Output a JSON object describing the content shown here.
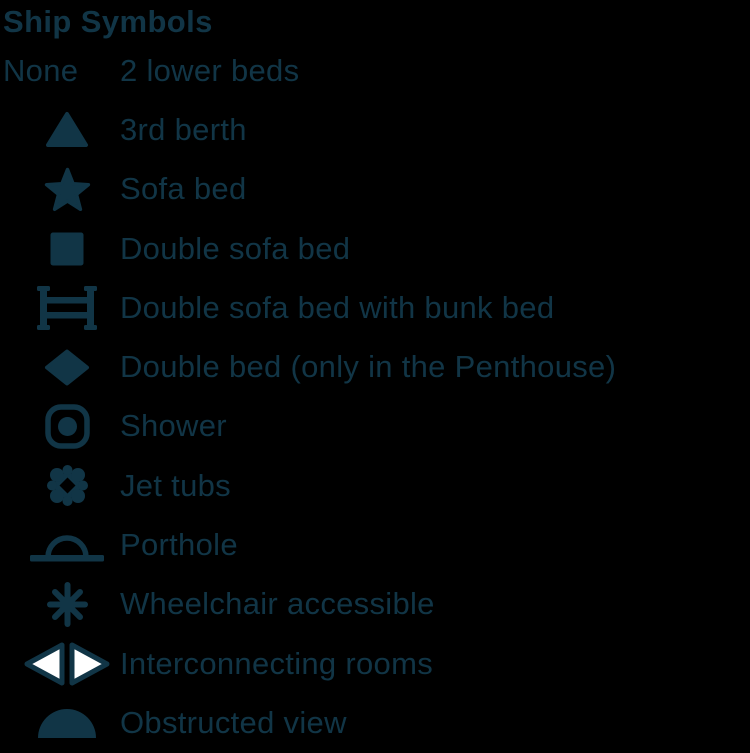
{
  "colors": {
    "background": "#000000",
    "ink": "#113546",
    "interconnect_triangle_fill": "#ffffff"
  },
  "header": {
    "title": "Ship Symbols"
  },
  "legend": {
    "items": [
      {
        "symbol": "none",
        "symbol_label": "None",
        "label": "2 lower beds"
      },
      {
        "symbol": "triangle-icon",
        "label": "3rd berth"
      },
      {
        "symbol": "star-icon",
        "label": "Sofa bed"
      },
      {
        "symbol": "square-icon",
        "label": "Double sofa bed"
      },
      {
        "symbol": "bunk-bed-icon",
        "label": "Double sofa bed with bunk bed"
      },
      {
        "symbol": "diamond-icon",
        "label": "Double bed (only in the Penthouse)"
      },
      {
        "symbol": "shower-icon",
        "label": "Shower"
      },
      {
        "symbol": "jet-tubs-icon",
        "label": "Jet tubs"
      },
      {
        "symbol": "porthole-icon",
        "label": "Porthole"
      },
      {
        "symbol": "wheelchair-asterisk-icon",
        "label": "Wheelchair accessible"
      },
      {
        "symbol": "interconnecting-rooms-icon",
        "label": "Interconnecting rooms"
      },
      {
        "symbol": "obstructed-view-dome-icon",
        "label": "Obstructed view"
      }
    ]
  }
}
